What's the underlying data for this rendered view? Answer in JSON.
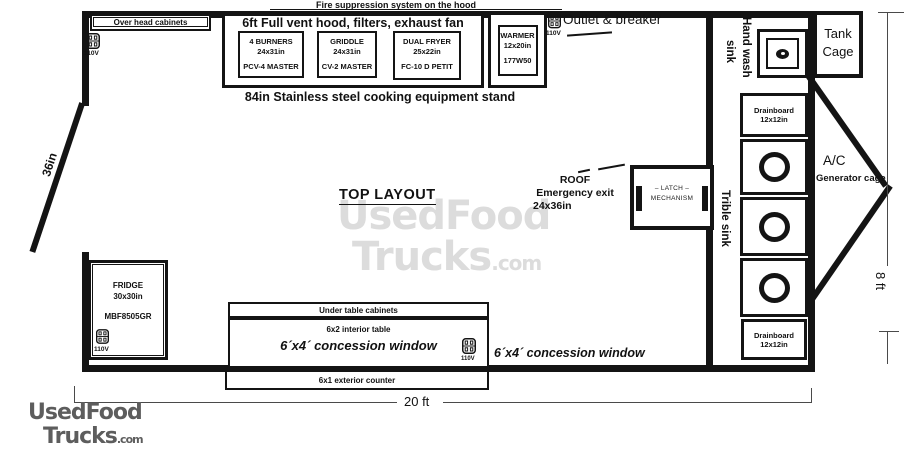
{
  "title": "TOP LAYOUT",
  "annotations": {
    "fire_suppression": "Fire suppression system on the hood",
    "stand": "84in Stainless steel cooking equipment stand",
    "outlet_breaker": "Outlet & breaker",
    "voltage": "110V",
    "door_width": "36in",
    "width_dim": "20 ft",
    "height_dim": "8 ft",
    "roof_exit_line1": "ROOF",
    "roof_exit_line2": "Emergency exit",
    "roof_exit_line3": "24x36in"
  },
  "hood": {
    "title": "6ft Full vent hood, filters, exhaust fan",
    "equipment": [
      {
        "name": "4 BURNERS",
        "size": "24x31in",
        "model": "PCV-4 MASTER"
      },
      {
        "name": "GRIDDLE",
        "size": "24x31in",
        "model": "CV-2 MASTER"
      },
      {
        "name": "DUAL FRYER",
        "size": "25x22in",
        "model": "FC-10 D PETIT"
      }
    ]
  },
  "warmer": {
    "name": "WARMER",
    "size": "12x20in",
    "model": "177W50"
  },
  "fridge": {
    "name": "FRIDGE",
    "size": "30x30in",
    "model": "MBF8505GR"
  },
  "latch": {
    "line1": "– LATCH –",
    "line2": "MECHANISM"
  },
  "sinks": {
    "hand_wash_line1": "Hand wash",
    "hand_wash_line2": "sink",
    "triple": "Trible sink",
    "drainboard_top": {
      "name": "Drainboard",
      "size": "12x12in"
    },
    "drainboard_bottom": {
      "name": "Drainboard",
      "size": "12x12in"
    }
  },
  "cabinets": {
    "overhead": "Over head cabinets",
    "under_table": "Under table cabinets",
    "interior_table": "6x2 interior table",
    "concession_window_interior": "6´x4´ concession window",
    "exterior_counter": "6x1 exterior counter",
    "concession_window_exterior": "6´x4´ concession window"
  },
  "exterior": {
    "tank_cage": "Tank Cage",
    "ac": "A/C",
    "generator_cage": "Generator cage"
  },
  "watermark": {
    "line1": "UsedFood",
    "line2": "Trucks",
    "suffix": ".com"
  },
  "colors": {
    "wall": "#141414",
    "watermark_light": "#dcdcdc",
    "watermark_dark": "#5d5d5d"
  }
}
